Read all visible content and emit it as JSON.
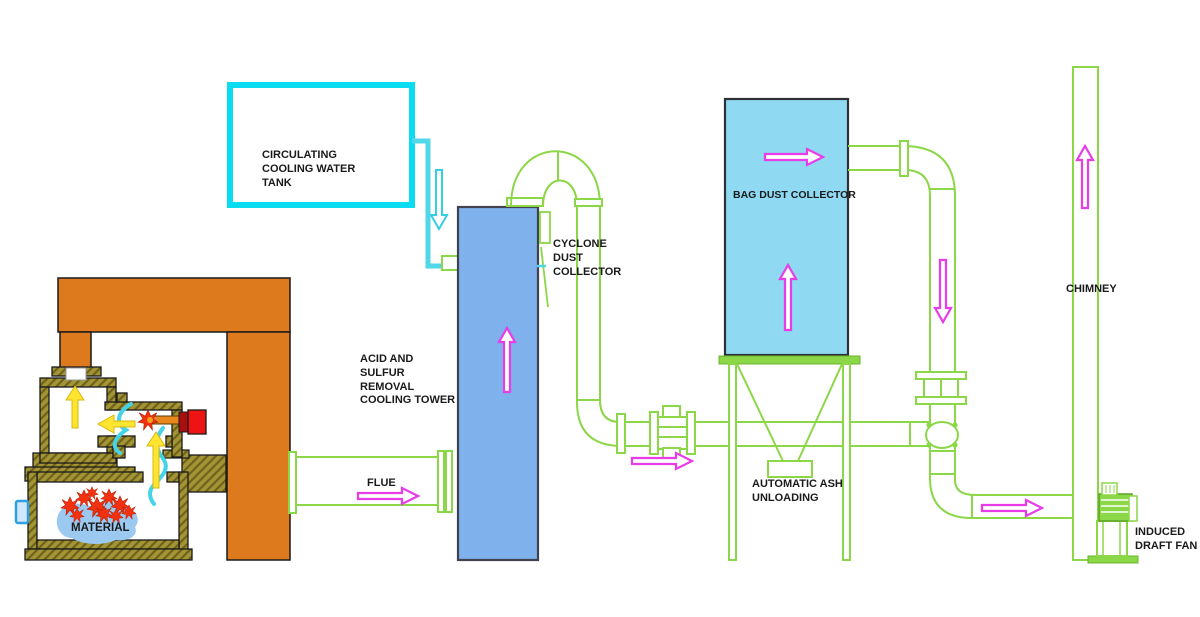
{
  "diagram_title": "Incinerator flue gas treatment process",
  "labels": {
    "tank": "CIRCULATING COOLING WATER TANK",
    "tower": "ACID AND SULFUR REMOVAL COOLING TOWER",
    "cyclone": "CYCLONE DUST COLLECTOR",
    "flue": "FLUE",
    "bag": "BAG DUST COLLECTOR",
    "ash": "AUTOMATIC ASH UNLOADING",
    "chimney": "CHIMNEY",
    "fan": "INDUCED DRAFT FAN",
    "material": "MATERIAL"
  },
  "colors": {
    "pipe_green": "#8cd747",
    "tank_border_cyan": "#0adcf2",
    "water_cyan": "#52d7e8",
    "tower_blue": "#7fb1ed",
    "bag_collector_blue": "#8fd9f3",
    "frame_orange": "#dd7a1e",
    "furnace_olive": "#a39434",
    "flame_red": "#f23110",
    "burner_red": "#ee1414",
    "arrow_magenta": "#e83ce8",
    "arrow_yellow": "#ffe430",
    "material_blue": "#9cc9ef",
    "text": "#1a1a1a"
  },
  "flow_arrows": [
    {
      "location": "furnace upper chamber",
      "direction": "up",
      "color": "yellow"
    },
    {
      "location": "furnace duct to chamber",
      "direction": "left",
      "color": "yellow"
    },
    {
      "location": "furnace lower to upper chamber",
      "direction": "up",
      "color": "yellow"
    },
    {
      "location": "cooling water feed pipe",
      "direction": "down",
      "color": "cyan"
    },
    {
      "location": "flue",
      "direction": "right",
      "color": "magenta"
    },
    {
      "location": "cooling tower",
      "direction": "up",
      "color": "magenta"
    },
    {
      "location": "cyclone outlet duct",
      "direction": "right",
      "color": "magenta"
    },
    {
      "location": "bag collector top outlet",
      "direction": "right",
      "color": "magenta"
    },
    {
      "location": "bag collector body",
      "direction": "up",
      "color": "magenta"
    },
    {
      "location": "downpipe after bag collector",
      "direction": "down",
      "color": "magenta"
    },
    {
      "location": "fan inlet duct",
      "direction": "right",
      "color": "magenta"
    },
    {
      "location": "chimney",
      "direction": "up",
      "color": "magenta"
    }
  ]
}
